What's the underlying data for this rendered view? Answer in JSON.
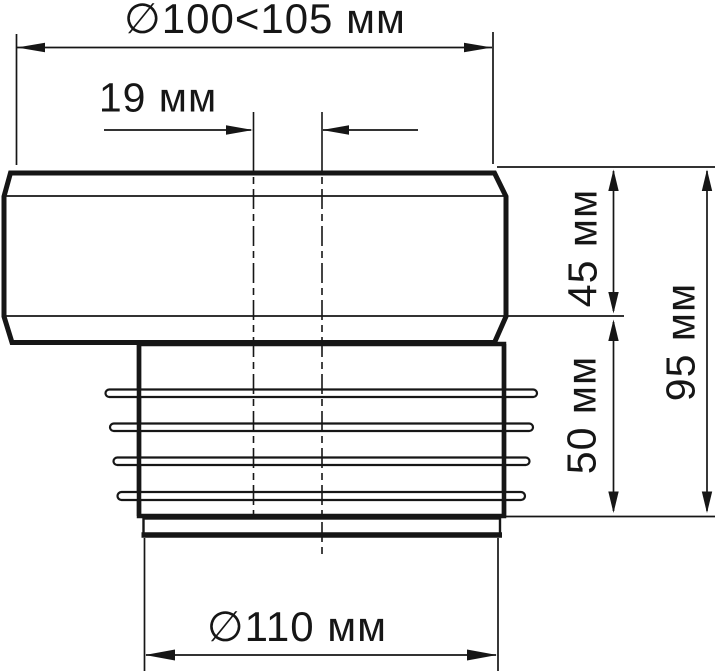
{
  "drawing": {
    "kind": "technical-dimension-drawing",
    "units": "мм",
    "colors": {
      "line": "#161616",
      "background": "#ffffff"
    },
    "labels": {
      "top_diameter": "∅100<105 мм",
      "offset": "19 мм",
      "upper_height": "45 мм",
      "lower_height": "50 мм",
      "total_height": "95 мм",
      "bottom_diameter": "∅110 мм"
    },
    "values": {
      "top_diameter_range_mm": "100–105",
      "center_offset_mm": 19,
      "upper_section_height_mm": 45,
      "lower_section_height_mm": 50,
      "total_height_mm": 95,
      "bottom_diameter_mm": 110
    }
  }
}
